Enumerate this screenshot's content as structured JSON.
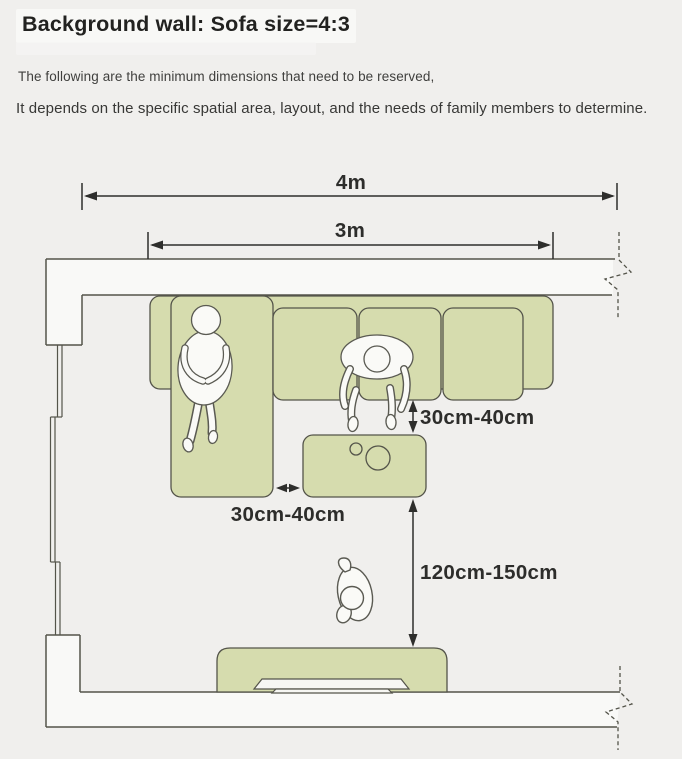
{
  "header": {
    "title": "Background wall: Sofa size=4:3",
    "subtitle1": "The following are the minimum dimensions that need to be reserved,",
    "subtitle2": "It depends on the specific spatial area, layout, and the needs of family members to determine."
  },
  "diagram": {
    "labels": {
      "room_width": "4m",
      "sofa_width": "3m",
      "sofa_to_table_gap": "30cm-40cm",
      "chaise_to_table_gap": "30cm-40cm",
      "table_to_tv_gap": "120cm-150cm"
    },
    "colors": {
      "background": "#f0efed",
      "furniture_fill": "#d6dcae",
      "outline": "#54544a",
      "wall_fill": "#f9f9f7",
      "dimension_line": "#2e2e2c",
      "text": "#2d2d2b"
    }
  }
}
